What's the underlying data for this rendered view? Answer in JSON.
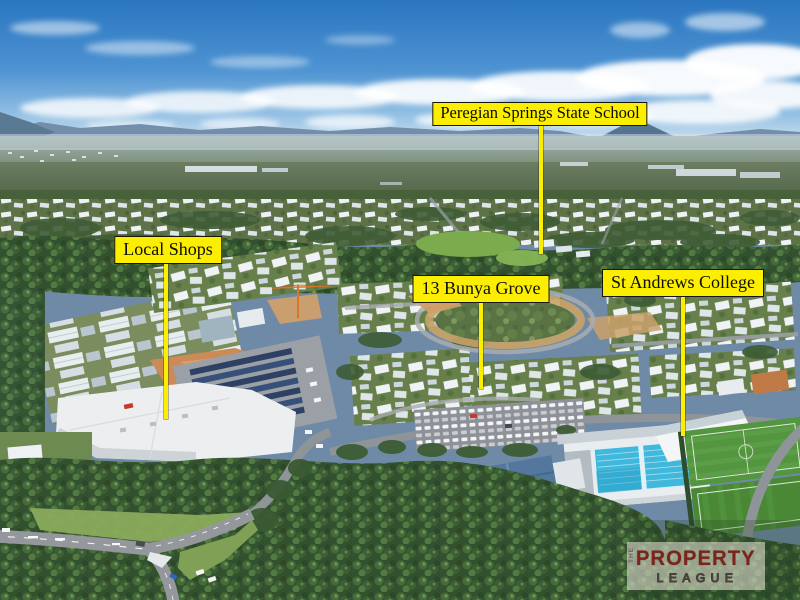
{
  "callouts": {
    "school": {
      "text": "Peregian Springs State School"
    },
    "shops": {
      "text": "Local Shops"
    },
    "subject": {
      "text": "13 Bunya Grove"
    },
    "college": {
      "text": "St Andrews College"
    }
  },
  "watermark": {
    "prefix": "THE",
    "line1": "PROPERTY",
    "line2": "LEAGUE"
  },
  "colors": {
    "callout_bg": "#FBEE00",
    "callout_border": "#15150A",
    "callout_text": "#0D0D04",
    "pointer_line": "#FBEE00",
    "watermark_red": "#7B241C",
    "watermark_bg": "rgba(238,234,223,0.55)",
    "sky_top": "#2B76C0",
    "pool_water": "#40B8DC",
    "forest_green": "#33512E",
    "field_green": "#549540"
  }
}
